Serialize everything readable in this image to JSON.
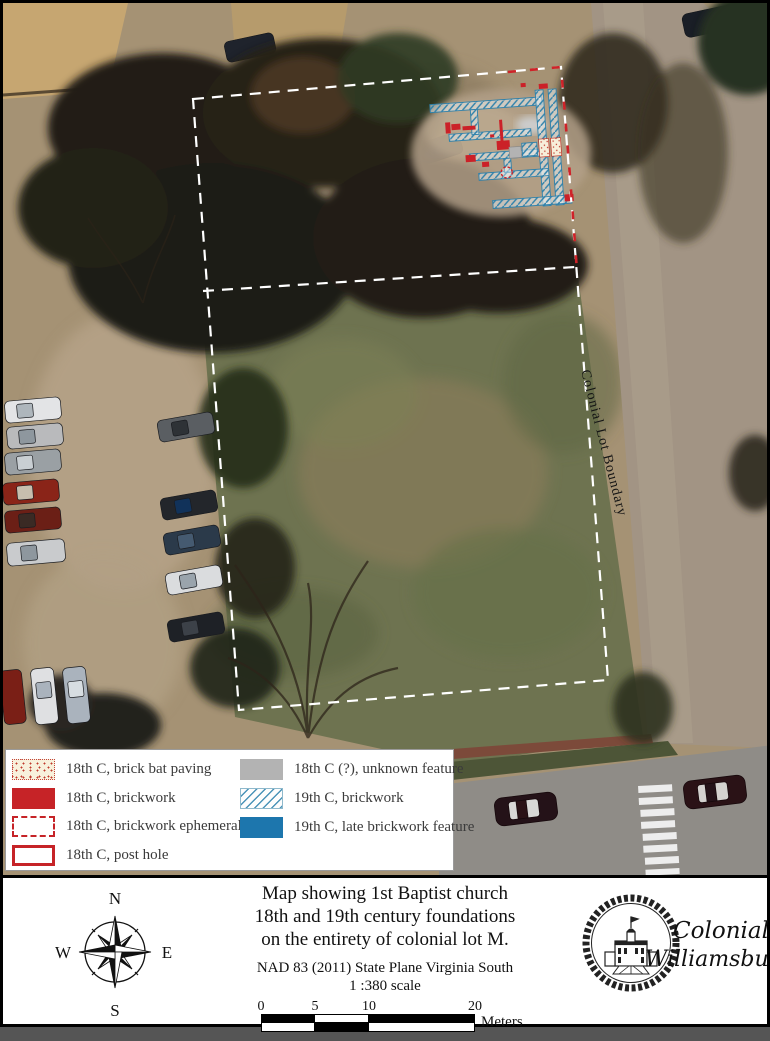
{
  "map": {
    "boundary_label": "Colonial Lot Boundary"
  },
  "legend": {
    "items": [
      {
        "label": "18th C, brick bat paving",
        "swatch": "stipple"
      },
      {
        "label": "18th C, brickwork",
        "swatch": "red"
      },
      {
        "label": "18th C, brickwork ephemeral",
        "swatch": "ephemeral"
      },
      {
        "label": "18th C, post hole",
        "swatch": "posthole"
      },
      {
        "label": "18th C (?), unknown feature",
        "swatch": "gray"
      },
      {
        "label": "19th C, brickwork",
        "swatch": "hatch"
      },
      {
        "label": "19th C, late brickwork feature",
        "swatch": "blue"
      }
    ]
  },
  "title_block": {
    "title_line1": "Map showing 1st Baptist church",
    "title_line2": "18th and 19th century foundations",
    "title_line3": "on the entirety of colonial lot M.",
    "datum_line": "NAD 83 (2011) State Plane Virginia South",
    "scale_line": "1 :380 scale"
  },
  "scale_bar": {
    "ticks": [
      "0",
      "5",
      "10",
      "20"
    ],
    "unit": "Meters"
  },
  "compass": {
    "north": "N",
    "east": "E",
    "south": "S",
    "west": "W"
  },
  "logo": {
    "line1": "Colonial",
    "line2": "Williamsburg"
  },
  "colors": {
    "brickwork_18c_red": "#c62327",
    "ephemeral_18c_red": "#cf2329",
    "unknown_18c_gray": "#b3b3b3",
    "brickwork_19c_hatch_blue": "#4a93b8",
    "late_brickwork_19c_blue": "#1d76ad",
    "lot_boundary_white": "#ffffff"
  }
}
